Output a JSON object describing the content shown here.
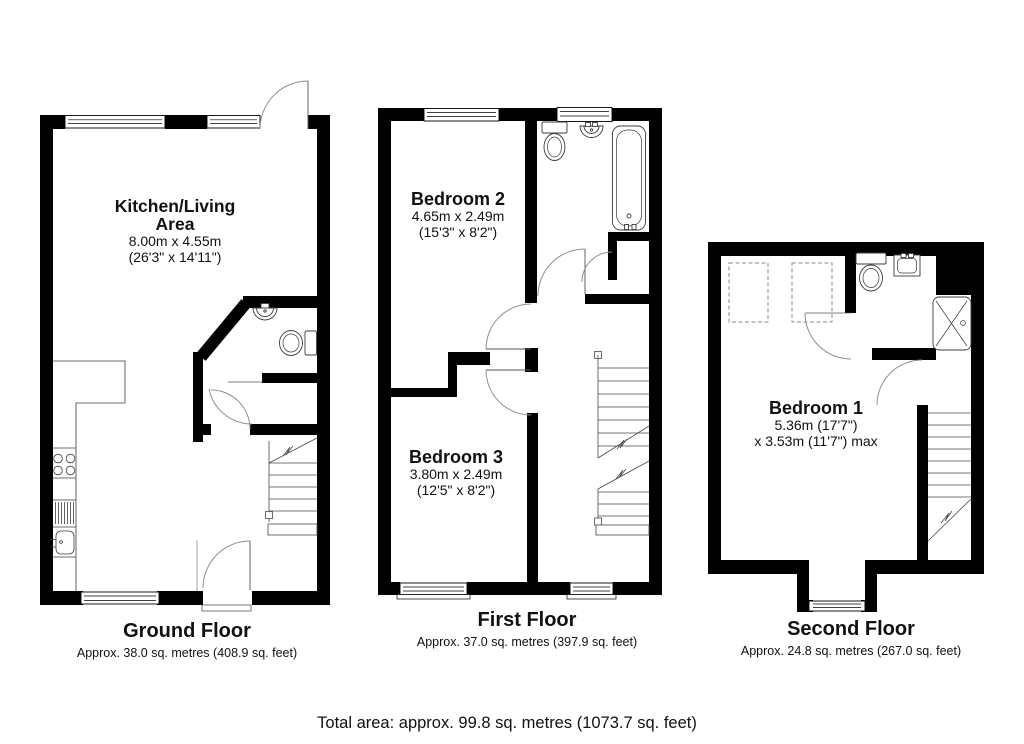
{
  "document": {
    "kind": "property-floorplan"
  },
  "colors": {
    "wall": "#000000",
    "background": "#ffffff",
    "fixture_line": "#3c3c3c",
    "door_arc": "#8f8f8f",
    "skylight_dash": "#8a8a8a"
  },
  "floors": {
    "ground": {
      "title": "Ground Floor",
      "area": "Approx. 38.0 sq. metres (408.9 sq. feet)",
      "room": {
        "line1": "Kitchen/Living",
        "line2": "Area",
        "metric": "8.00m x 4.55m",
        "imperial": "(26'3\" x 14'11\")"
      }
    },
    "first": {
      "title": "First Floor",
      "area": "Approx. 37.0 sq. metres (397.9 sq. feet)",
      "bedroom2": {
        "name": "Bedroom 2",
        "metric": "4.65m x 2.49m",
        "imperial": "(15'3\" x 8'2\")"
      },
      "bedroom3": {
        "name": "Bedroom 3",
        "metric": "3.80m x 2.49m",
        "imperial": "(12'5\" x 8'2\")"
      }
    },
    "second": {
      "title": "Second Floor",
      "area": "Approx. 24.8 sq. metres (267.0 sq. feet)",
      "bedroom1": {
        "name": "Bedroom 1",
        "dims1": "5.36m (17'7\")",
        "dims2": "x 3.53m (11'7\") max"
      }
    }
  },
  "footer": {
    "total": "Total area: approx. 99.8 sq. metres (1073.7 sq. feet)"
  }
}
